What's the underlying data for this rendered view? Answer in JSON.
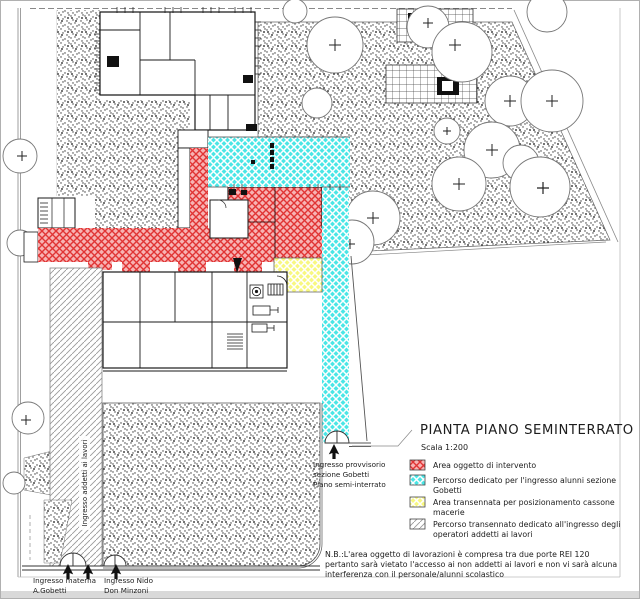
{
  "page": {
    "title": "PIANTA PIANO SEMINTERRATO",
    "scale": "Scala 1:200"
  },
  "legend": {
    "items": [
      {
        "id": "area-intervento",
        "swatch": "red-crosshatch",
        "color": "#e03434",
        "lines": [
          "Area oggetto di intervento"
        ]
      },
      {
        "id": "percorso-alunni",
        "swatch": "cyan-crosshatch",
        "color": "#4ae6e6",
        "lines": [
          "Percorso dedicato per l'ingresso alunni sezione",
          "Gobetti"
        ]
      },
      {
        "id": "area-cassone",
        "swatch": "yellow-crosshatch",
        "color": "#f8f880",
        "lines": [
          "Area transennata per posizionamento cassone",
          "macerie"
        ]
      },
      {
        "id": "percorso-operatori",
        "swatch": "gray-diagonal",
        "color": "#9a9a9a",
        "lines": [
          "Percorso transennato dedicato all'ingresso degli",
          "operatori addetti ai lavori"
        ]
      }
    ]
  },
  "note": {
    "lines": [
      "N.B.:L'area oggetto di lavorazioni è compresa tra due porte REI 120",
      "pertanto sarà vietato l'accesso ai non addetti ai lavori e non vi sarà alcuna",
      "interferenza con il personale/alunni scolastico"
    ]
  },
  "labels": {
    "provisional_entrance": {
      "lines": [
        "Ingresso provvisorio",
        "sezione Gobetti",
        "Piano semi-interrato"
      ]
    },
    "workers_entrance": "Ingresso addetti ai lavori",
    "materna_entrance": {
      "lines": [
        "Ingresso materna",
        "A.Gobetti"
      ]
    },
    "nido_entrance": {
      "lines": [
        "Ingresso Nido",
        "Don Minzoni"
      ]
    }
  }
}
